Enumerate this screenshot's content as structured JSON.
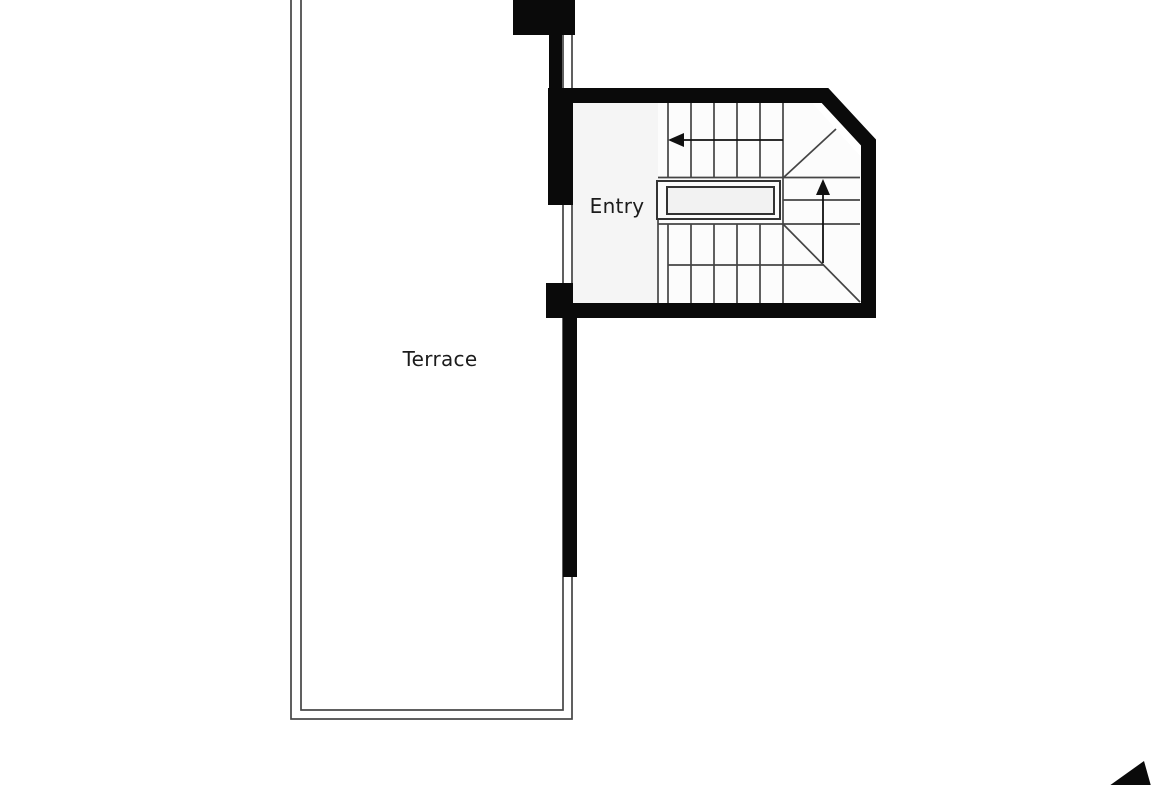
{
  "plan": {
    "title": "Floor plan with terrace and entry staircase",
    "rooms": [
      {
        "id": "terrace",
        "label": "Terrace"
      },
      {
        "id": "entry",
        "label": "Entry"
      }
    ],
    "stair": {
      "flights": 3,
      "upper_flight_arrow_direction": "left",
      "winder_arrow_direction": "up",
      "landing_feature": "stairwell-void-railing"
    },
    "icons": {
      "north_arrow": "north-arrow-icon (partially cropped at bottom-right)"
    },
    "colors": {
      "wall": "#0a0a0a",
      "line": "#454545",
      "terrace_fill": "#e9e9e9",
      "entry_fill": "#f5f5f5",
      "stair_fill": "#fcfcfc",
      "landing_inner_fill": "#f2f2f2",
      "background": "#ffffff",
      "label_text": "#1c1c1c"
    }
  }
}
